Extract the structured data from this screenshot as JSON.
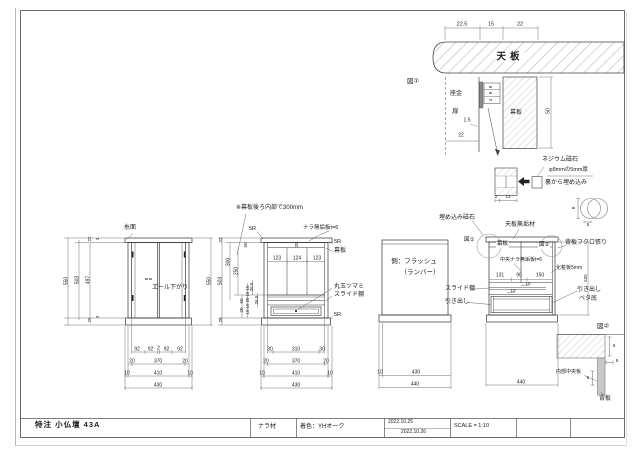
{
  "title_block": {
    "title": "特注 小仏壇 43A",
    "material": "ナラ材",
    "color": "着色：YHオーク",
    "date1": "2022.10.25",
    "date2": "2022.10.26",
    "scale": "SCALE = 1:10"
  },
  "note": "※幕板後ろ内部で300mm",
  "fig1": {
    "label": "図①",
    "dims_top": [
      "22.5",
      "15",
      "22"
    ],
    "tenban": "天板",
    "zagane": "座金",
    "tobira": "扉",
    "makuita": "幕板",
    "dim_gap": "1.5",
    "dim_22": "22",
    "dim_50": "50",
    "dims_small": [
      "8",
      "8",
      "4"
    ]
  },
  "magnet": {
    "name": "ネジウム磁石",
    "size": "φ8mmの5mm厚",
    "embed": "裏から埋め込み",
    "dim_2": "2",
    "dim_13": "13",
    "dim_8": "8",
    "dim_5": "5"
  },
  "front": {
    "itomen": "糸面",
    "sagari": "エール下がり",
    "dim_8a": "8",
    "dim_8b": "8",
    "h550l": "550",
    "h503": "503",
    "h497": "497",
    "t22": "22",
    "t3": "3",
    "b25": "25",
    "b3": "3",
    "h550r": "550",
    "r1": [
      "92",
      "92",
      "2",
      "92",
      "92"
    ],
    "r2": [
      "20",
      "370",
      "20"
    ],
    "r3": [
      "10",
      "410",
      "10"
    ],
    "r4": "430"
  },
  "section": {
    "r5a": "5R",
    "board": "ナラ無垢板t=6",
    "r5b": "5R",
    "makuita": "幕板",
    "knob": "丸玉ツマミ",
    "slide": "スライド棚",
    "r5c": "5R",
    "d20": "20",
    "bays": [
      "123",
      "124",
      "123"
    ],
    "t22": "22",
    "d50": "50",
    "d300": "300",
    "d250": "250",
    "h503": "503",
    "d265a": "26.5",
    "d265b": "26.5",
    "sa": [
      "50",
      "20"
    ],
    "sb": [
      "15",
      "15",
      "20",
      "15",
      "15"
    ],
    "b25": "25",
    "r1": [
      "30",
      "310",
      "30"
    ],
    "r2": [
      "20",
      "370",
      "20"
    ],
    "r3": [
      "10",
      "410",
      "10"
    ],
    "r4": "430"
  },
  "side": {
    "line1": "側：フラッシュ",
    "line2": "（ランバー）",
    "r1": [
      "10",
      "430"
    ],
    "r2": "440"
  },
  "rightv": {
    "magnet_callout": "埋め込み磁石",
    "tenban": "天板無垢材",
    "fig1": "図①",
    "makuita": "幕板",
    "fig2": "図②",
    "sehan": "背板フクロ張り",
    "center_board": "中央ナラ無垢板t=6",
    "kesho": "化粧板5mm",
    "d525": "525",
    "widths": [
      "131",
      "90",
      "150"
    ],
    "d10a": "10",
    "d10b": "10",
    "slide": "スライド棚",
    "drawer": "引き出し",
    "drawer2a": "引き出し",
    "drawer2b": "ベタ底",
    "bottom": "440"
  },
  "fig2": {
    "label": "図②",
    "d6a": "6",
    "d5": "5",
    "d6b": "6",
    "inner_board": "内部中央板",
    "back_board": "背板"
  }
}
